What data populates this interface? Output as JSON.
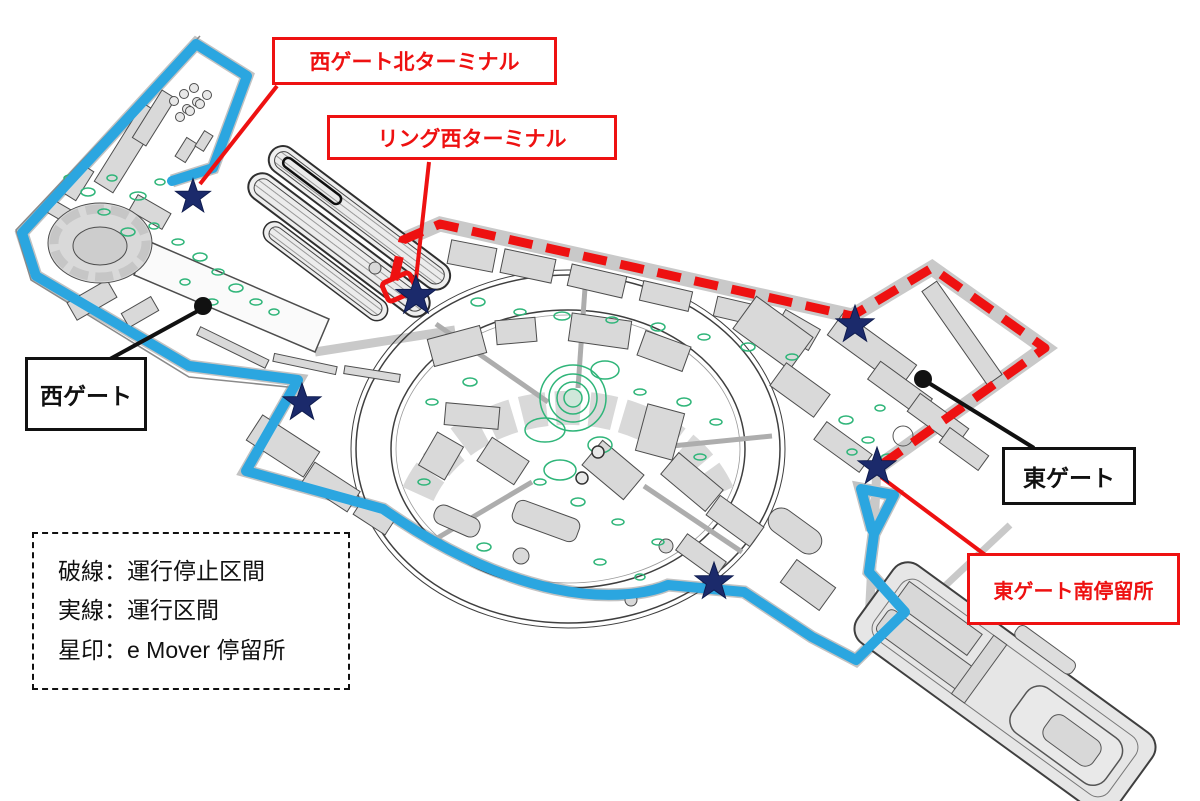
{
  "map": {
    "title": "e Mover route map (Expo site)",
    "callouts": [
      {
        "id": "west-gate-north-terminal",
        "label": "西ゲート北ターミナル",
        "style": "red"
      },
      {
        "id": "ring-west-terminal",
        "label": "リング西ターミナル",
        "style": "red"
      },
      {
        "id": "west-gate",
        "label": "西ゲート",
        "style": "black"
      },
      {
        "id": "east-gate",
        "label": "東ゲート",
        "style": "black"
      },
      {
        "id": "east-gate-south-stop",
        "label": "東ゲート南停留所",
        "style": "red"
      }
    ],
    "legend": {
      "lines": [
        "破線：運行停止区間",
        "実線：運行区間",
        "星印：e Mover 停留所"
      ]
    },
    "markers": {
      "stop_marker_shape": "star",
      "stop_count": 6,
      "gate_dot_count": 2
    },
    "colors": {
      "route_operating": "#2ba6e0",
      "route_suspended": "#ee1111",
      "stop_marker": "#1b2a6b",
      "callout_red": "#ee1111",
      "callout_black": "#111111",
      "vegetation": "#2fb579",
      "building_fill": "#d9d9d9"
    }
  }
}
